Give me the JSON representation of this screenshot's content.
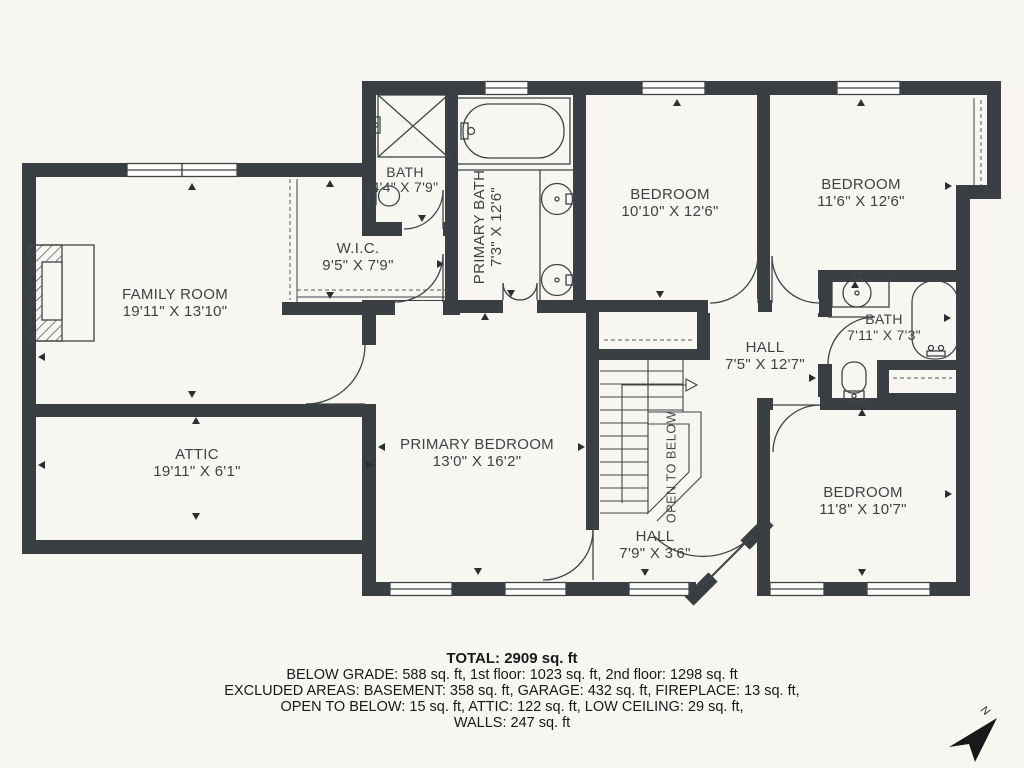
{
  "floorplan": {
    "rooms": {
      "family_room": {
        "name": "FAMILY ROOM",
        "dims": "19'11\" X 13'10\""
      },
      "attic": {
        "name": "ATTIC",
        "dims": "19'11\" X 6'1\""
      },
      "wic": {
        "name": "W.I.C.",
        "dims": "9'5\" X 7'9\""
      },
      "bath_small": {
        "name": "BATH",
        "dims": "4'4\" X 7'9\""
      },
      "primary_bath": {
        "name": "PRIMARY BATH",
        "dims": "7'3\" X 12'6\""
      },
      "primary_bedroom": {
        "name": "PRIMARY BEDROOM",
        "dims": "13'0\" X 16'2\""
      },
      "bedroom_top_mid": {
        "name": "BEDROOM",
        "dims": "10'10\" X 12'6\""
      },
      "bedroom_top_right": {
        "name": "BEDROOM",
        "dims": "11'6\" X 12'6\""
      },
      "bath_right": {
        "name": "BATH",
        "dims": "7'11\" X 7'3\""
      },
      "hall_upper": {
        "name": "HALL",
        "dims": "7'5\" X 12'7\""
      },
      "hall_lower": {
        "name": "HALL",
        "dims": "7'9\" X 3'6\""
      },
      "bedroom_bottom": {
        "name": "BEDROOM",
        "dims": "11'8\" X 10'7\""
      },
      "open_to_below": {
        "label": "OPEN TO BELOW"
      }
    },
    "compass": {
      "label": "N"
    },
    "summary": {
      "total": "TOTAL: 2909 sq. ft",
      "line1": "BELOW GRADE: 588 sq. ft, 1st floor: 1023 sq. ft, 2nd floor: 1298 sq. ft",
      "line2": "EXCLUDED AREAS: BASEMENT: 358 sq. ft, GARAGE: 432 sq. ft, FIREPLACE: 13 sq. ft,",
      "line3": "OPEN TO BELOW: 15 sq. ft, ATTIC: 122 sq. ft, LOW CEILING: 29 sq. ft,",
      "line4": "WALLS: 247 sq. ft"
    },
    "colors": {
      "wall": "#393e42",
      "background": "#f8f6f0",
      "line": "#3f4449"
    }
  }
}
